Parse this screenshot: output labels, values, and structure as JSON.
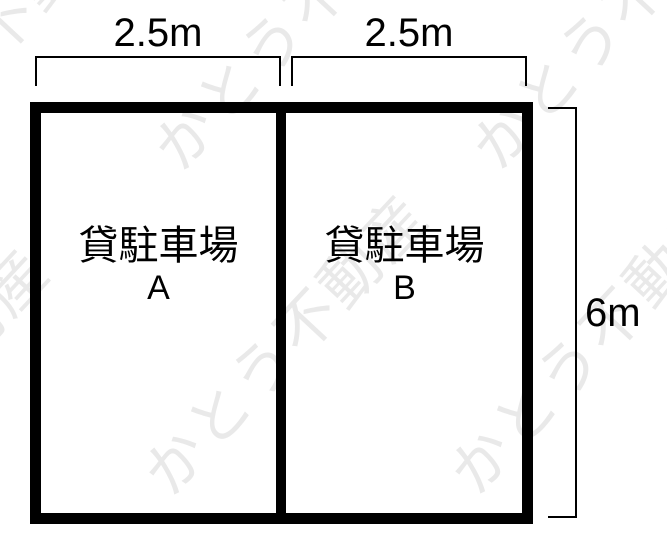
{
  "diagram": {
    "title_meaning": "rental parking lot plan",
    "colors": {
      "line": "#000000",
      "background": "#ffffff",
      "watermark": "#e9e9e9"
    },
    "dimensions": {
      "width_a": "2.5m",
      "width_b": "2.5m",
      "height": "6m"
    },
    "spaces": {
      "a": {
        "title": "貸駐車場",
        "unit": "A"
      },
      "b": {
        "title": "貸駐車場",
        "unit": "B"
      }
    },
    "watermark": {
      "text": "かとう不動産",
      "fragments": [
        {
          "text": "不動"
        },
        {
          "text": "かとう不動産"
        },
        {
          "text": "動産"
        },
        {
          "text": "かとう不動産"
        },
        {
          "text": "かとう不動産"
        },
        {
          "text": "かとう不動産"
        }
      ]
    }
  }
}
